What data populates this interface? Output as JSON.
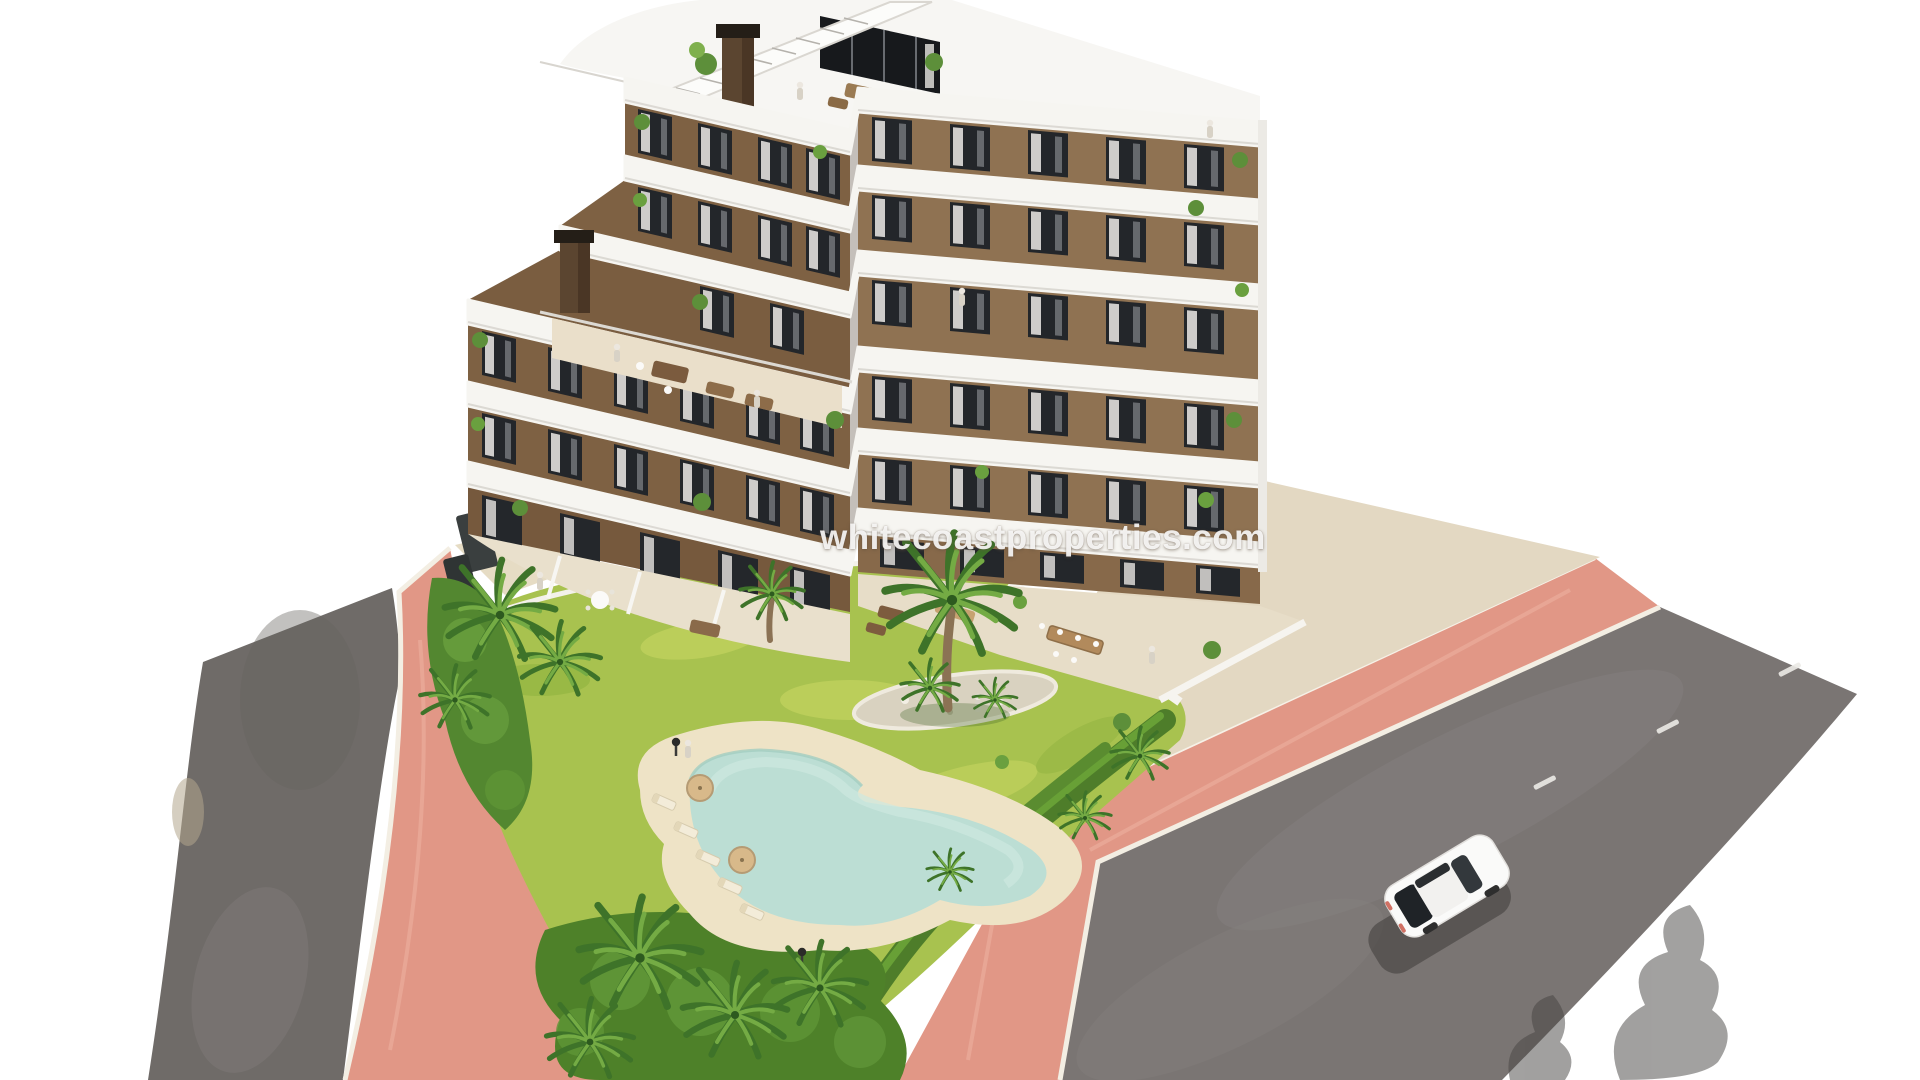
{
  "meta": {
    "type": "architectural-render",
    "canvas": "1920x1080",
    "background": "#ffffff"
  },
  "watermark": {
    "text": "whitecoastproperties.com",
    "color": "#ffffff"
  },
  "palette": {
    "facade_brown_left": "#7e6143",
    "facade_brown_right": "#8f7252",
    "balcony_white": "#f6f5f1",
    "window_dark": "#23262a",
    "road_gray_left": "#6f6b68",
    "road_gray_main": "#7a7573",
    "sidewalk_pink": "#e19786",
    "curb_white": "#f3eee3",
    "lawn_green": "#a8c24f",
    "hedge_green": "#4e7d2a",
    "palm_green": "#3e7329",
    "pool_water": "#bcded4",
    "pool_sand": "#eee3c6",
    "terrace_beige": "#e8dfcc",
    "car_white": "#fafaf9",
    "shadow_dark": "#454341"
  },
  "scene": {
    "objects": [
      {
        "name": "apartment-building",
        "label": "Modern multi-storey apartment building with brown facade and white curved balconies"
      },
      {
        "name": "rooftop-terrace",
        "label": "Rooftop terraces with furniture, plants and chimneys"
      },
      {
        "name": "swimming-pool",
        "label": "Freeform lagoon-style swimming pool with sandy beach edge"
      },
      {
        "name": "garden",
        "label": "Landscaped lawn garden with palm trees and hedges"
      },
      {
        "name": "left-road",
        "label": "Asphalt road on the left"
      },
      {
        "name": "main-road",
        "label": "Wide asphalt road on the right with lane dashes"
      },
      {
        "name": "pink-sidewalk",
        "label": "Pink paved sidewalk surrounding the plot"
      },
      {
        "name": "white-car",
        "label": "White car driving on the main road"
      }
    ]
  }
}
